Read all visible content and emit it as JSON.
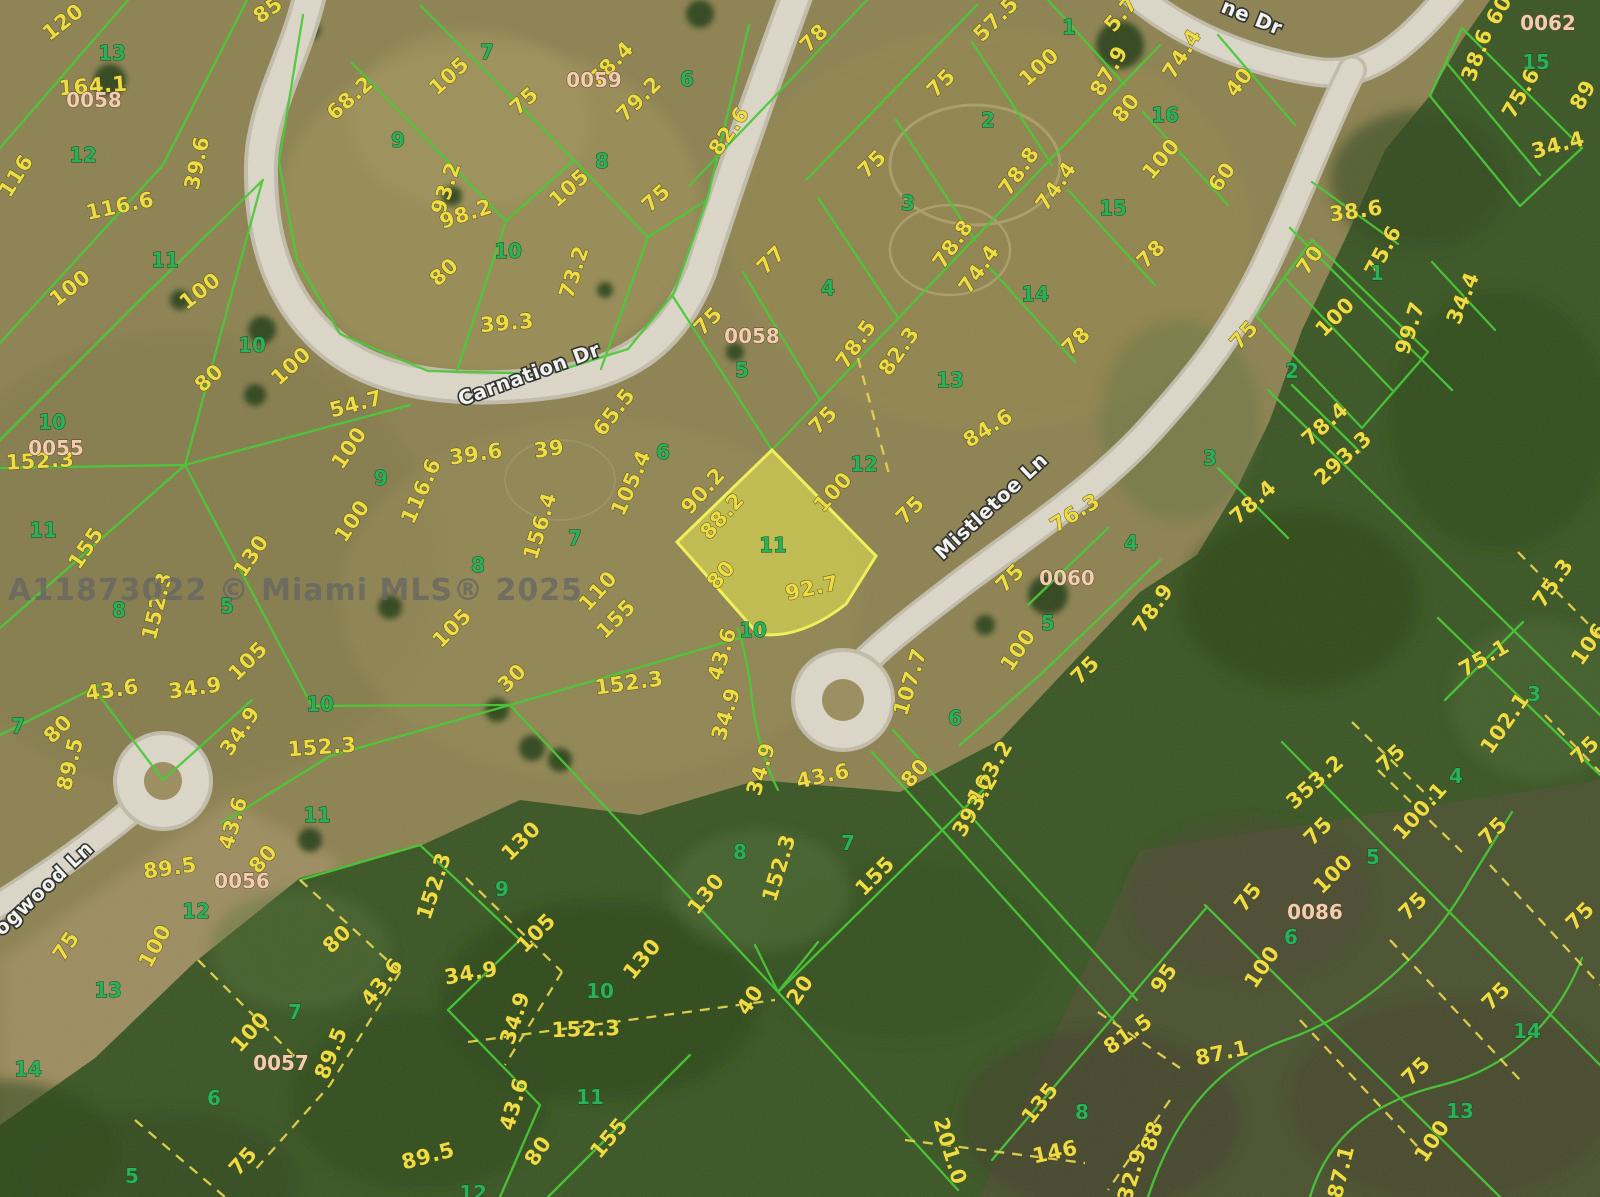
{
  "meta": {
    "watermark": "A11873022 © Miami MLS® 2025"
  },
  "highlight": {
    "lot": "11",
    "fill": "#e9e94b",
    "stroke": "#f3f257"
  },
  "palette": {
    "line_green": "#44cb31",
    "dash_yellow": "#e7d348",
    "dim_yellow": "#f2de3d",
    "lot_green": "#23b053",
    "block_pink": "#f3cfae",
    "road": "#dcd7c8",
    "field": "#8d8251",
    "forest": "#3a5624"
  },
  "streets": [
    {
      "name": "Carnation Dr",
      "x": 529,
      "y": 374,
      "r": -20
    },
    {
      "name": "Mistletoe Ln",
      "x": 991,
      "y": 506,
      "r": -43
    },
    {
      "name": "Dogwood Ln",
      "x": 37,
      "y": 894,
      "r": -43
    },
    {
      "name": "ne Dr",
      "x": 1252,
      "y": 17,
      "r": 22
    }
  ],
  "blocks": {
    "format": [
      "id",
      "x",
      "y"
    ],
    "items": [
      [
        "0058",
        94,
        100
      ],
      [
        "0059",
        594,
        80
      ],
      [
        "0058",
        752,
        336
      ],
      [
        "0055",
        56,
        448
      ],
      [
        "0060",
        1067,
        578
      ],
      [
        "0062",
        1548,
        23
      ],
      [
        "0056",
        242,
        881
      ],
      [
        "0057",
        281,
        1063
      ],
      [
        "0086",
        1315,
        912
      ]
    ]
  },
  "lots": {
    "format": [
      "number",
      "x",
      "y"
    ],
    "items": [
      [
        "13",
        112,
        53
      ],
      [
        "12",
        83,
        155
      ],
      [
        "11",
        165,
        260
      ],
      [
        "10",
        252,
        345
      ],
      [
        "9",
        398,
        140
      ],
      [
        "7",
        487,
        52
      ],
      [
        "8",
        602,
        161
      ],
      [
        "6",
        687,
        79
      ],
      [
        "10",
        508,
        251
      ],
      [
        "5",
        742,
        370
      ],
      [
        "1",
        1069,
        27
      ],
      [
        "2",
        988,
        120
      ],
      [
        "3",
        908,
        203
      ],
      [
        "4",
        828,
        288
      ],
      [
        "16",
        1165,
        115
      ],
      [
        "15",
        1113,
        208
      ],
      [
        "14",
        1035,
        294
      ],
      [
        "13",
        950,
        380
      ],
      [
        "15",
        1536,
        62
      ],
      [
        "1",
        1377,
        273
      ],
      [
        "2",
        1292,
        371
      ],
      [
        "10",
        52,
        422
      ],
      [
        "11",
        43,
        530
      ],
      [
        "9",
        381,
        478
      ],
      [
        "8",
        119,
        610
      ],
      [
        "5",
        227,
        606
      ],
      [
        "7",
        18,
        726
      ],
      [
        "10",
        320,
        704
      ],
      [
        "7",
        575,
        538
      ],
      [
        "6",
        663,
        452
      ],
      [
        "8",
        478,
        565
      ],
      [
        "11",
        773,
        545
      ],
      [
        "10",
        753,
        630
      ],
      [
        "12",
        864,
        464
      ],
      [
        "4",
        1131,
        543
      ],
      [
        "5",
        1048,
        623
      ],
      [
        "6",
        955,
        718
      ],
      [
        "9",
        502,
        889
      ],
      [
        "8",
        740,
        852
      ],
      [
        "10",
        600,
        991
      ],
      [
        "11",
        590,
        1097
      ],
      [
        "12",
        473,
        1193
      ],
      [
        "11",
        317,
        815
      ],
      [
        "12",
        196,
        911
      ],
      [
        "13",
        108,
        990
      ],
      [
        "14",
        28,
        1069
      ],
      [
        "7",
        295,
        1012
      ],
      [
        "6",
        214,
        1098
      ],
      [
        "5",
        132,
        1176
      ],
      [
        "3",
        1210,
        458
      ],
      [
        "3",
        1534,
        694
      ],
      [
        "4",
        1456,
        776
      ],
      [
        "7",
        848,
        843
      ],
      [
        "8",
        1082,
        1112
      ],
      [
        "5",
        1373,
        857
      ],
      [
        "6",
        1291,
        937
      ],
      [
        "14",
        1527,
        1031
      ],
      [
        "13",
        1460,
        1111
      ]
    ]
  },
  "dims": {
    "format": [
      "text",
      "x",
      "y",
      "rot"
    ],
    "items": [
      [
        "120",
        63,
        22,
        -38
      ],
      [
        "164.1",
        93,
        86,
        -4
      ],
      [
        "116",
        16,
        176,
        -58
      ],
      [
        "116.6",
        120,
        206,
        -12
      ],
      [
        "39.6",
        197,
        163,
        -78
      ],
      [
        "100",
        70,
        288,
        -38
      ],
      [
        "100",
        200,
        291,
        -38
      ],
      [
        "80",
        209,
        378,
        -42
      ],
      [
        "100",
        291,
        366,
        -42
      ],
      [
        "85",
        268,
        10,
        -35
      ],
      [
        "68.2",
        350,
        98,
        -42
      ],
      [
        "105",
        449,
        76,
        -42
      ],
      [
        "75",
        524,
        101,
        -42
      ],
      [
        "78.4",
        611,
        64,
        -45
      ],
      [
        "79.2",
        639,
        99,
        -45
      ],
      [
        "82.6",
        729,
        131,
        -55
      ],
      [
        "93.2",
        446,
        188,
        -72
      ],
      [
        "98.2",
        466,
        214,
        -18
      ],
      [
        "105",
        569,
        188,
        -42
      ],
      [
        "75",
        656,
        198,
        -42
      ],
      [
        "80",
        444,
        272,
        -42
      ],
      [
        "73.2",
        574,
        272,
        -72
      ],
      [
        "39.3",
        507,
        323,
        -5
      ],
      [
        "75",
        708,
        321,
        -45
      ],
      [
        "77",
        771,
        260,
        -45
      ],
      [
        "78",
        814,
        38,
        -45
      ],
      [
        "57.5",
        996,
        19,
        -45
      ],
      [
        "100",
        1039,
        67,
        -42
      ],
      [
        "87.9",
        1109,
        71,
        -60
      ],
      [
        "80",
        1126,
        108,
        -52
      ],
      [
        "74.4",
        1182,
        54,
        -58
      ],
      [
        "75",
        941,
        83,
        -45
      ],
      [
        "75",
        872,
        164,
        -45
      ],
      [
        "100",
        1161,
        159,
        -50
      ],
      [
        "78.8",
        1019,
        171,
        -55
      ],
      [
        "74.4",
        1056,
        186,
        -55
      ],
      [
        "78",
        1151,
        254,
        -45
      ],
      [
        "78.8",
        953,
        244,
        -55
      ],
      [
        "74.4",
        979,
        269,
        -55
      ],
      [
        "78",
        1076,
        341,
        -45
      ],
      [
        "78.5",
        856,
        344,
        -55
      ],
      [
        "82.3",
        899,
        351,
        -55
      ],
      [
        "5.7",
        1121,
        14,
        -50
      ],
      [
        "40",
        1239,
        82,
        -52
      ],
      [
        "38.6",
        1477,
        55,
        -70
      ],
      [
        "75.6",
        1521,
        93,
        -60
      ],
      [
        "89",
        1583,
        95,
        -60
      ],
      [
        "34.4",
        1558,
        145,
        -15
      ],
      [
        "60",
        1499,
        10,
        -60
      ],
      [
        "60",
        1222,
        177,
        -55
      ],
      [
        "38.6",
        1356,
        211,
        -8
      ],
      [
        "75.6",
        1383,
        251,
        -62
      ],
      [
        "70",
        1310,
        260,
        -55
      ],
      [
        "100",
        1335,
        317,
        -45
      ],
      [
        "99.7",
        1410,
        328,
        -72
      ],
      [
        "34.4",
        1463,
        298,
        -68
      ],
      [
        "75",
        1244,
        335,
        -48
      ],
      [
        "54.7",
        356,
        404,
        -15
      ],
      [
        "39.6",
        476,
        454,
        -8
      ],
      [
        "39",
        549,
        449,
        -8
      ],
      [
        "65.5",
        614,
        412,
        -52
      ],
      [
        "116.6",
        421,
        491,
        -66
      ],
      [
        "156.4",
        540,
        526,
        -73
      ],
      [
        "105.4",
        631,
        483,
        -66
      ],
      [
        "90.2",
        703,
        491,
        -48
      ],
      [
        "88.2",
        722,
        516,
        -48
      ],
      [
        "80",
        721,
        575,
        -48
      ],
      [
        "92.7",
        812,
        588,
        -12
      ],
      [
        "100",
        833,
        492,
        -48
      ],
      [
        "110",
        598,
        591,
        -48
      ],
      [
        "155",
        616,
        619,
        -45
      ],
      [
        "105",
        452,
        628,
        -45
      ],
      [
        "30",
        512,
        678,
        -45
      ],
      [
        "152.3",
        629,
        683,
        -8
      ],
      [
        "43.6",
        722,
        654,
        -73
      ],
      [
        "34.9",
        726,
        714,
        -73
      ],
      [
        "34.9",
        761,
        769,
        -73
      ],
      [
        "84.6",
        988,
        428,
        -32
      ],
      [
        "75",
        823,
        420,
        -45
      ],
      [
        "75",
        910,
        510,
        -45
      ],
      [
        "76.3",
        1075,
        513,
        -32
      ],
      [
        "75",
        1010,
        578,
        -45
      ],
      [
        "100",
        1018,
        650,
        -56
      ],
      [
        "78.9",
        1153,
        608,
        -55
      ],
      [
        "75",
        1085,
        670,
        -45
      ],
      [
        "107.7",
        910,
        682,
        -73
      ],
      [
        "103.2",
        990,
        772,
        -60
      ],
      [
        "393.2",
        975,
        805,
        -60
      ],
      [
        "80",
        915,
        773,
        -48
      ],
      [
        "43.6",
        823,
        776,
        -12
      ],
      [
        "152.3",
        40,
        461,
        -3
      ],
      [
        "155",
        86,
        548,
        -56
      ],
      [
        "130",
        251,
        556,
        -56
      ],
      [
        "100",
        349,
        448,
        -56
      ],
      [
        "100",
        352,
        521,
        -56
      ],
      [
        "152.3",
        157,
        606,
        -76
      ],
      [
        "80",
        58,
        729,
        -45
      ],
      [
        "89.5",
        70,
        764,
        -76
      ],
      [
        "105",
        248,
        661,
        -45
      ],
      [
        "43.6",
        112,
        690,
        -8
      ],
      [
        "34.9",
        195,
        688,
        -8
      ],
      [
        "34.9",
        240,
        731,
        -56
      ],
      [
        "152.3",
        322,
        747,
        -4
      ],
      [
        "78.4",
        1325,
        424,
        -42
      ],
      [
        "293.3",
        1343,
        458,
        -42
      ],
      [
        "78.4",
        1253,
        502,
        -42
      ],
      [
        "75.3",
        1553,
        583,
        -55
      ],
      [
        "106",
        1589,
        644,
        -55
      ],
      [
        "75.1",
        1484,
        658,
        -30
      ],
      [
        "102.1",
        1505,
        723,
        -55
      ],
      [
        "75",
        1585,
        750,
        -45
      ],
      [
        "353.2",
        1315,
        782,
        -42
      ],
      [
        "75",
        1391,
        758,
        -42
      ],
      [
        "100.1",
        1420,
        811,
        -48
      ],
      [
        "75",
        1318,
        831,
        -45
      ],
      [
        "75",
        1493,
        831,
        -45
      ],
      [
        "100",
        1333,
        874,
        -45
      ],
      [
        "75",
        1248,
        897,
        -52
      ],
      [
        "100",
        1262,
        967,
        -56
      ],
      [
        "75",
        1413,
        906,
        -45
      ],
      [
        "75",
        1580,
        916,
        -45
      ],
      [
        "75",
        1496,
        996,
        -45
      ],
      [
        "100",
        1432,
        1141,
        -56
      ],
      [
        "87.1",
        1341,
        1172,
        -76
      ],
      [
        "87.1",
        1222,
        1053,
        -12
      ],
      [
        "75",
        1416,
        1071,
        -45
      ],
      [
        "95",
        1164,
        978,
        -56
      ],
      [
        "81.5",
        1128,
        1034,
        -35
      ],
      [
        "135",
        1040,
        1103,
        -52
      ],
      [
        "146",
        1055,
        1152,
        -12
      ],
      [
        "201.0",
        950,
        1151,
        73
      ],
      [
        "88",
        1152,
        1136,
        -73
      ],
      [
        "32.9",
        1132,
        1175,
        -73
      ],
      [
        "155",
        875,
        876,
        -45
      ],
      [
        "43.6",
        233,
        823,
        -73
      ],
      [
        "80",
        263,
        859,
        -48
      ],
      [
        "89.5",
        170,
        868,
        -8
      ],
      [
        "100",
        155,
        946,
        -62
      ],
      [
        "75",
        66,
        946,
        -56
      ],
      [
        "80",
        337,
        939,
        -45
      ],
      [
        "43.6",
        382,
        982,
        -52
      ],
      [
        "89.5",
        331,
        1053,
        -68
      ],
      [
        "100",
        250,
        1032,
        -48
      ],
      [
        "75",
        243,
        1161,
        -48
      ],
      [
        "130",
        521,
        841,
        -45
      ],
      [
        "152.3",
        434,
        886,
        -72
      ],
      [
        "105",
        536,
        933,
        -45
      ],
      [
        "34.9",
        471,
        973,
        -10
      ],
      [
        "34.9",
        515,
        1018,
        -72
      ],
      [
        "130",
        706,
        894,
        -52
      ],
      [
        "152.3",
        779,
        868,
        -73
      ],
      [
        "130",
        642,
        959,
        -50
      ],
      [
        "40",
        750,
        1000,
        -56
      ],
      [
        "20",
        800,
        990,
        -56
      ],
      [
        "152.3",
        586,
        1029,
        -2
      ],
      [
        "155",
        609,
        1138,
        -50
      ],
      [
        "43.6",
        514,
        1104,
        -73
      ],
      [
        "80",
        538,
        1151,
        -56
      ],
      [
        "89.5",
        428,
        1156,
        -15
      ]
    ]
  }
}
